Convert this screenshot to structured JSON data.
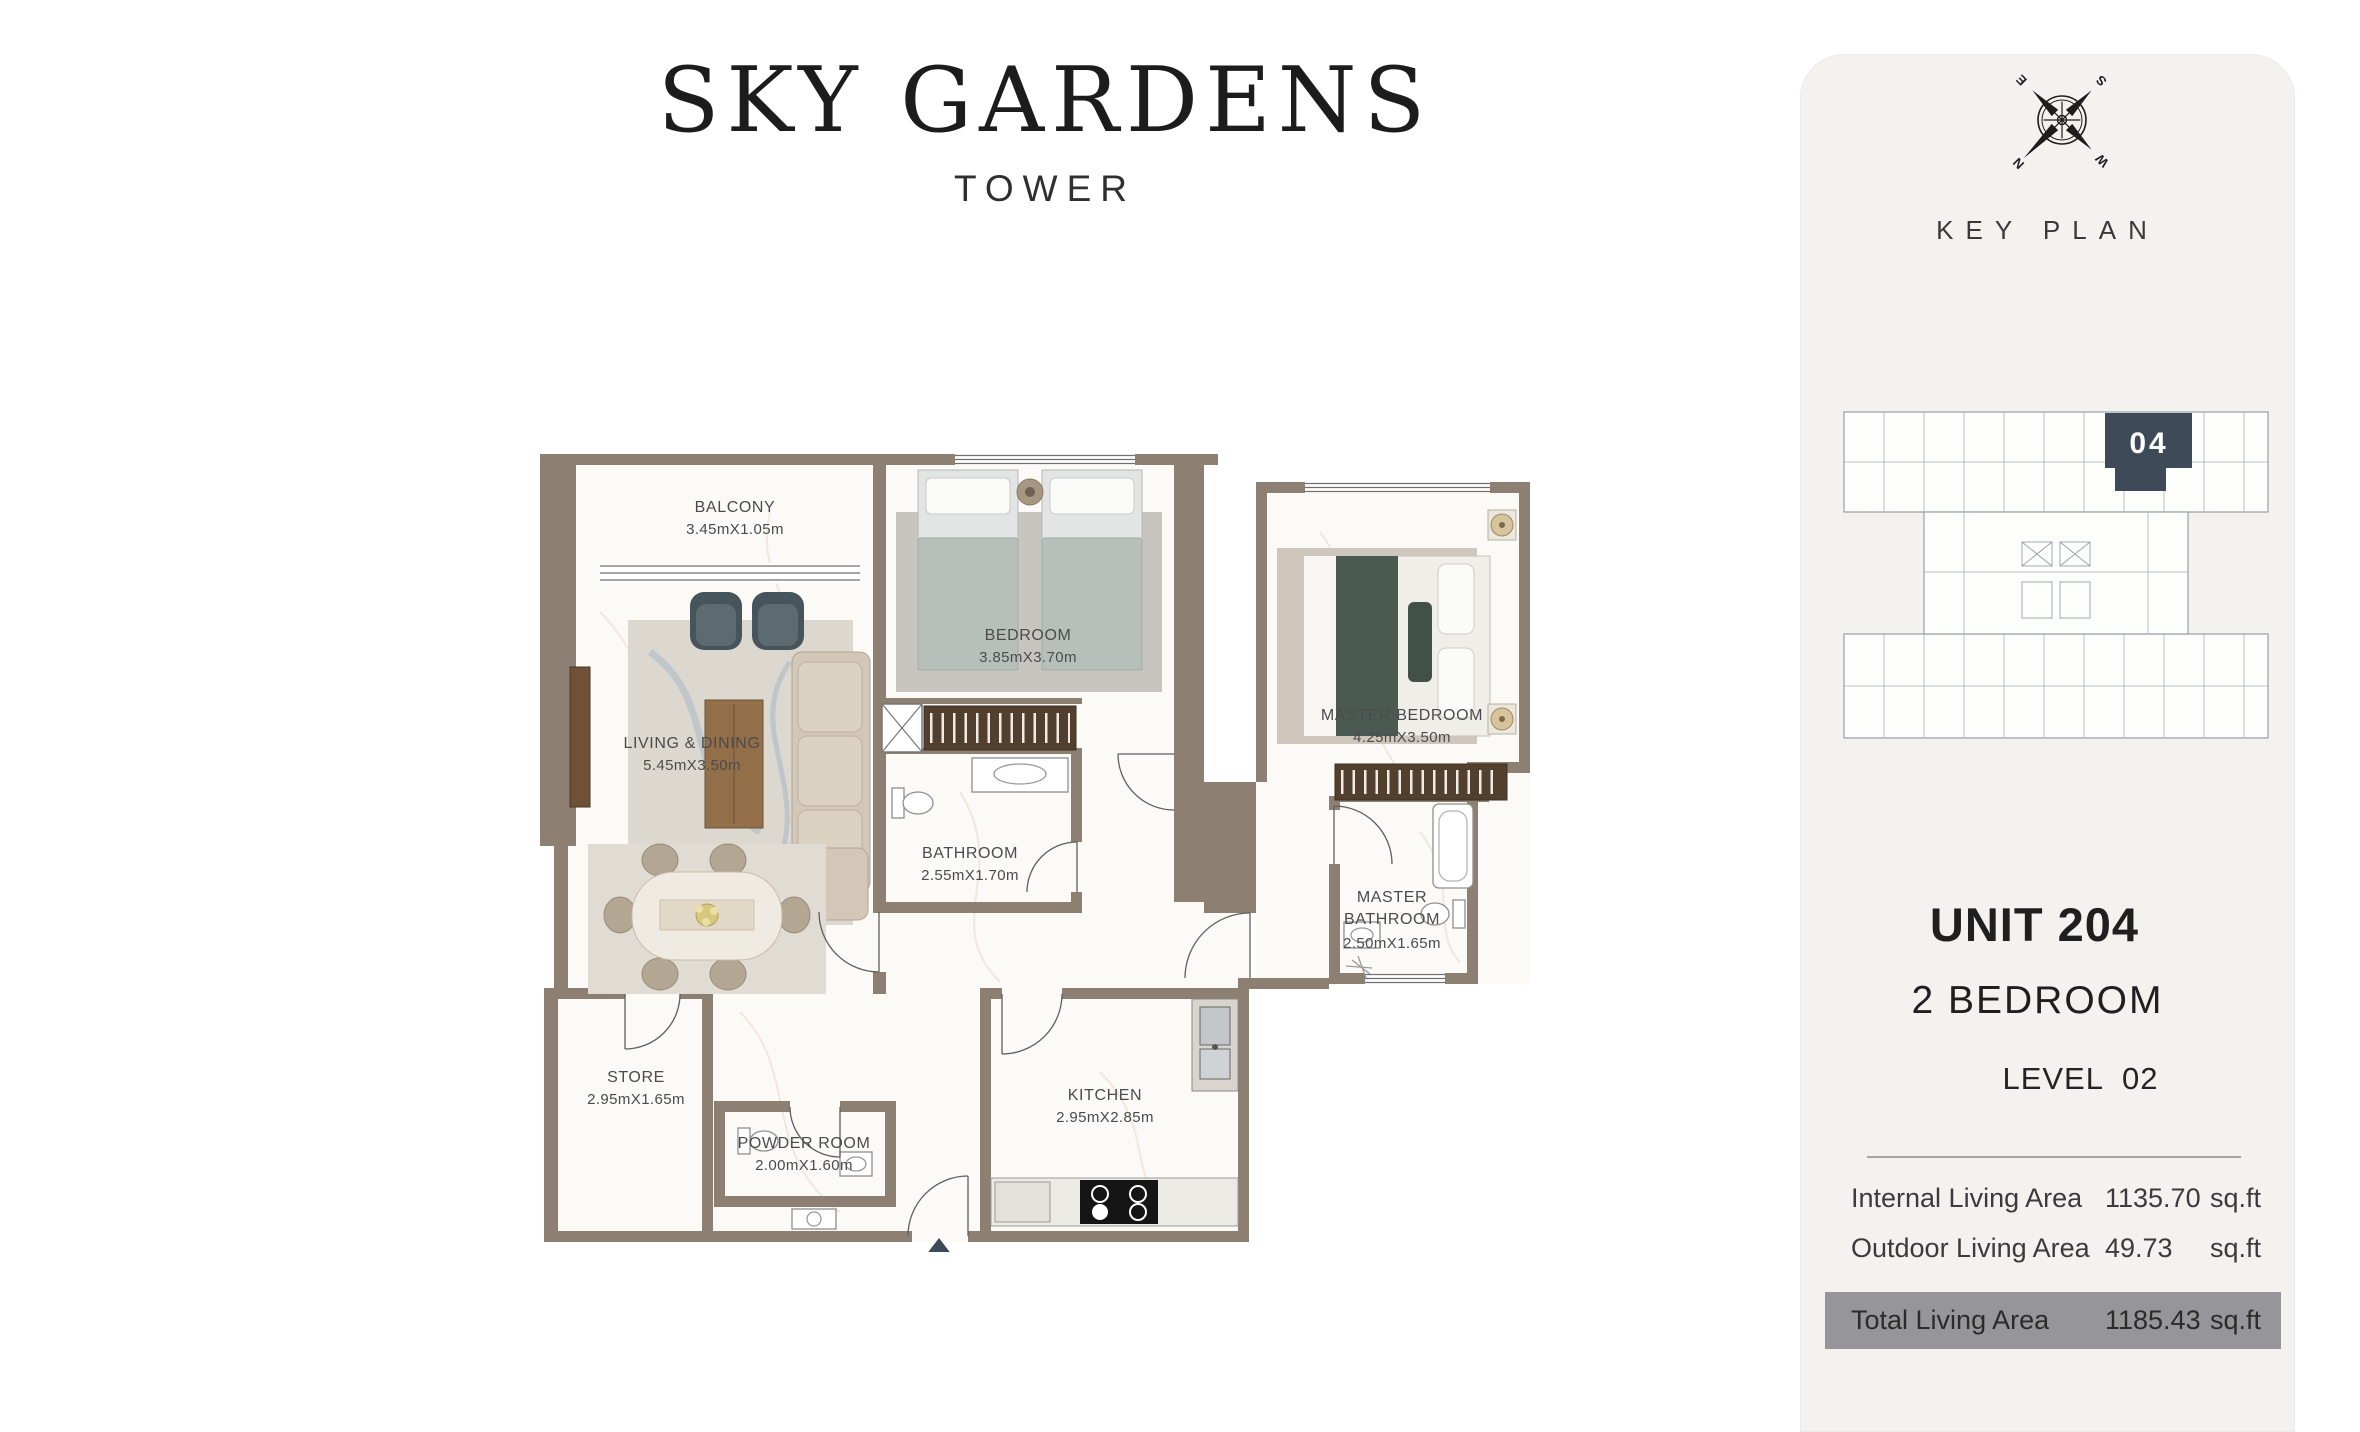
{
  "header": {
    "title": "SKY GARDENS",
    "subtitle": "TOWER"
  },
  "floor_plan": {
    "rooms": {
      "balcony": {
        "name": "BALCONY",
        "dims": "3.45mX1.05m"
      },
      "living": {
        "name": "LIVING & DINING",
        "dims": "5.45mX3.50m"
      },
      "bedroom": {
        "name": "BEDROOM",
        "dims": "3.85mX3.70m"
      },
      "master_bedroom": {
        "name": "MASTER BEDROOM",
        "dims": "4.25mX3.50m"
      },
      "bathroom": {
        "name": "BATHROOM",
        "dims": "2.55mX1.70m"
      },
      "master_bathroom": {
        "name1": "MASTER",
        "name2": "BATHROOM",
        "dims": "2.50mX1.65m"
      },
      "store": {
        "name": "STORE",
        "dims": "2.95mX1.65m"
      },
      "powder": {
        "name": "POWDER ROOM",
        "dims": "2.00mX1.60m"
      },
      "kitchen": {
        "name": "KITCHEN",
        "dims": "2.95mX2.85m"
      }
    }
  },
  "sidebar": {
    "key_plan_label": "KEY PLAN",
    "compass": {
      "n": "N",
      "e": "E",
      "s": "S",
      "w": "W"
    },
    "highlighted_unit": "04",
    "unit_title": "UNIT 204",
    "unit_type": "2 BEDROOM",
    "level": "LEVEL  02",
    "areas": [
      {
        "label": "Internal Living Area",
        "value": "1135.70",
        "unit": "sq.ft"
      },
      {
        "label": "Outdoor Living Area",
        "value": "49.73",
        "unit": "sq.ft"
      },
      {
        "label": "Total Living Area",
        "value": "1185.43",
        "unit": "sq.ft"
      }
    ],
    "colors": {
      "panel_bg": "#f3f2ef",
      "highlight_bar": "#96969a",
      "unit_fill": "#3e4a57",
      "wall": "#8d7f72"
    }
  }
}
